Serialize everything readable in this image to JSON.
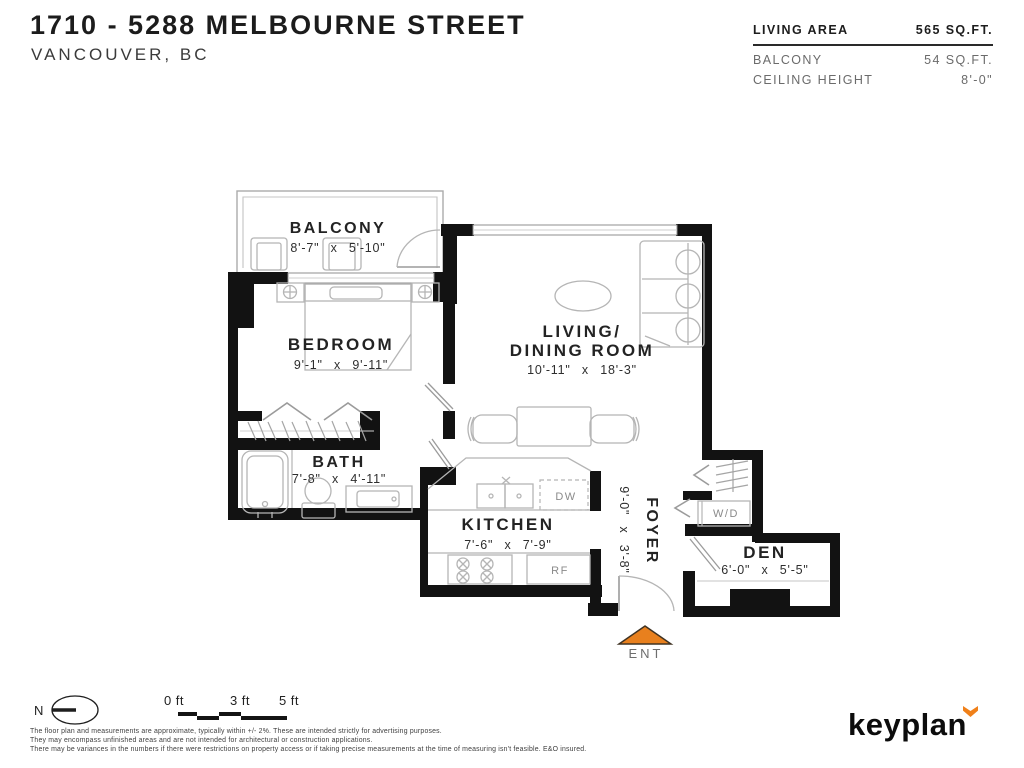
{
  "header": {
    "title": "1710 - 5288 MELBOURNE STREET",
    "subtitle": "VANCOUVER, BC",
    "stats": [
      {
        "label": "LIVING AREA",
        "value": "565 SQ.FT."
      },
      {
        "label": "BALCONY",
        "value": "54 SQ.FT."
      },
      {
        "label": "CEILING HEIGHT",
        "value": "8'-0\""
      }
    ]
  },
  "plan": {
    "balcony": {
      "name": "BALCONY",
      "dims": "8'-7\" x 5'-10\""
    },
    "bedroom": {
      "name": "BEDROOM",
      "dims": "9'-1\" x 9'-11\""
    },
    "living_dining": {
      "line1": "LIVING/",
      "line2": "DINING ROOM",
      "dims": "10'-11\" x 18'-3\""
    },
    "bath": {
      "name": "BATH",
      "dims": "7'-8\" x 4'-11\""
    },
    "kitchen": {
      "name": "KITCHEN",
      "dims": "7'-6\" x 7'-9\""
    },
    "foyer": {
      "name": "FOYER",
      "dims": "9'-0\" x 3'-8\""
    },
    "den": {
      "name": "DEN",
      "dims": "6'-0\" x 5'-5\""
    },
    "labels": {
      "washer_dryer": "W/D",
      "dishwasher": "DW",
      "refrigerator": "RF",
      "entry": "ENT"
    }
  },
  "footer": {
    "north_label": "N",
    "scale": {
      "t0": "0 ft",
      "t3": "3 ft",
      "t5": "5 ft"
    },
    "disclaimer": [
      "The floor plan and measurements are approximate, typically within +/- 2%. These are intended strictly for advertising purposes.",
      "They may encompass unfinished areas and are not intended for architectural or construction applications.",
      "There may be variances in the numbers if there were restrictions on property access or if taking precise measurements at the time of measuring isn't feasible. E&O insured."
    ],
    "brand": "keyplan"
  },
  "colors": {
    "accent_orange": "#E8801E",
    "wall_black": "#121212",
    "furniture_gray": "#b5b5b5"
  }
}
